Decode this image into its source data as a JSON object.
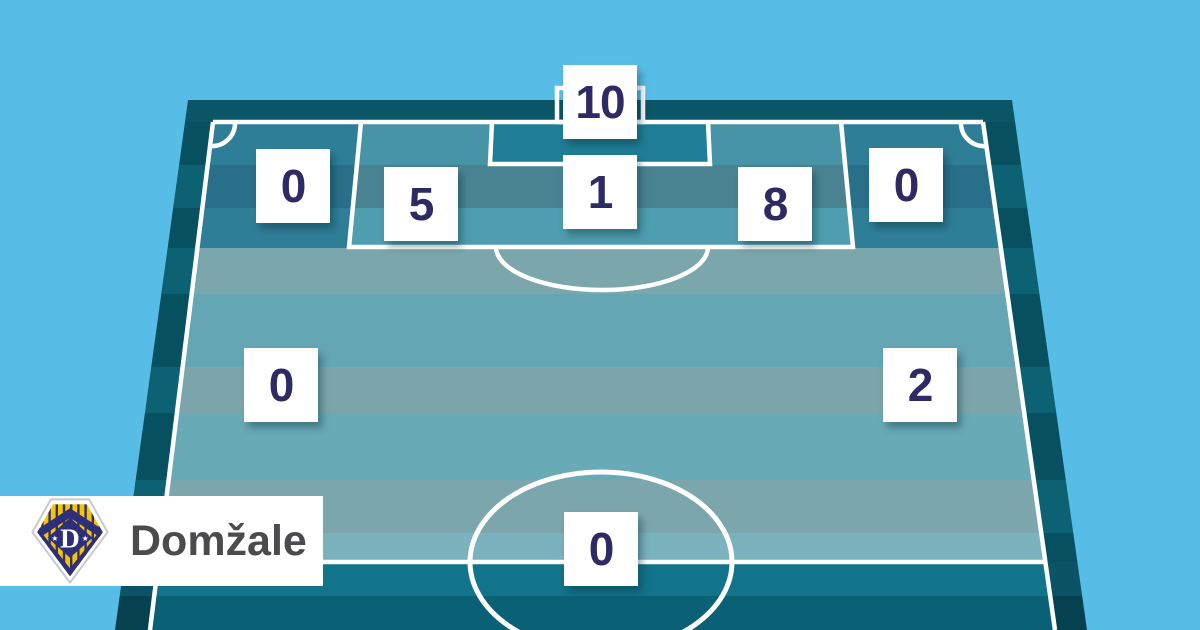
{
  "team": {
    "name": "Domžale"
  },
  "banner": {
    "label": "Domžale",
    "background": "#FFFFFF",
    "text_color": "#4B4B4D"
  },
  "logo": {
    "icon": "domzale-crest-icon",
    "field_color": "#F6C500",
    "navy_color": "#2D2F7B",
    "border_color": "#C6CBD0"
  },
  "colors": {
    "sky": "#57BDE7",
    "pitch_line": "#FFFFFF",
    "tile_background": "#FFFFFF",
    "tile_number": "#2E2A63",
    "penalty_area_teal": "#4694A6",
    "flank_teal": "#2F7E98",
    "midfield_teal": "#69AAB7",
    "own_half_teal": "#11748A",
    "six_yard_box": "#1E7E95"
  },
  "chart_data": {
    "type": "heatmap",
    "team": "Domžale",
    "legend_position": "none",
    "zones": [
      {
        "id": "goal",
        "row": "goal",
        "col": "center",
        "value": 10
      },
      {
        "id": "attacking-left-flank",
        "row": "attacking",
        "col": "left",
        "value": 0
      },
      {
        "id": "penalty-area-left",
        "row": "attacking",
        "col": "center-left",
        "value": 5
      },
      {
        "id": "penalty-area-center",
        "row": "attacking",
        "col": "center",
        "value": 1
      },
      {
        "id": "penalty-area-right",
        "row": "attacking",
        "col": "center-right",
        "value": 8
      },
      {
        "id": "attacking-right-flank",
        "row": "attacking",
        "col": "right",
        "value": 0
      },
      {
        "id": "middle-left",
        "row": "middle",
        "col": "left",
        "value": 0
      },
      {
        "id": "middle-right",
        "row": "middle",
        "col": "right",
        "value": 2
      },
      {
        "id": "own-half-center",
        "row": "defensive",
        "col": "center",
        "value": 0
      }
    ]
  }
}
